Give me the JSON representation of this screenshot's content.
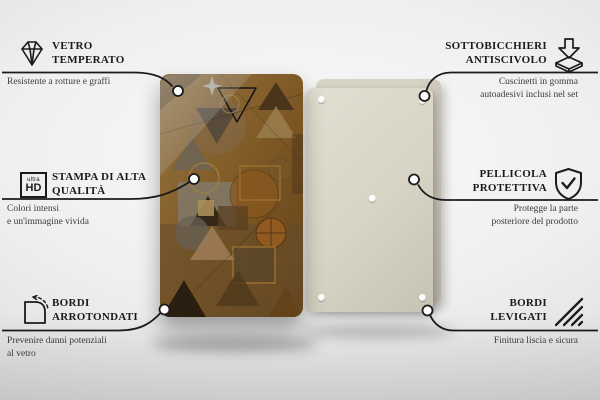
{
  "colors": {
    "text": "#1b1b1b",
    "subtext": "#3a3a3a",
    "line": "#1b1b1b",
    "back_panel": "#d7d4c5",
    "art_base_light": "#d2a259",
    "art_base_dark": "#8a5c24",
    "art_orange": "#c07a2b",
    "art_tan": "#d9b272",
    "art_dark_brown": "#3e2d18",
    "art_grey": "#908877",
    "art_gold_line": "#e0a84e"
  },
  "product": {
    "front_panel_label": "Pannello in vetro con stampa geometrica astratta (arancio e marrone)",
    "back_panel_label": "Retro del pannello con cuscinetti"
  },
  "callouts": {
    "left": [
      {
        "icon": "diamond-icon",
        "title_lines": [
          "VETRO",
          "TEMPERATO"
        ],
        "subtitle_lines": [
          "Resistente a rotture e graffi"
        ]
      },
      {
        "icon": "ultra-hd-icon",
        "icon_text_small": "ultra",
        "icon_text_big": "HD",
        "title_lines": [
          "STAMPA DI ALTA",
          "QUALITÀ"
        ],
        "subtitle_lines": [
          "Colori intensi",
          "e un'immagine vivida"
        ]
      },
      {
        "icon": "rounded-corner-icon",
        "title_lines": [
          "BORDI",
          "ARROTONDATI"
        ],
        "subtitle_lines": [
          "Prevenire danni potenziali",
          "al vetro"
        ]
      }
    ],
    "right": [
      {
        "icon": "press-down-icon",
        "title_lines": [
          "SOTTOBICCHIERI",
          "ANTISCIVOLO"
        ],
        "subtitle_lines": [
          "Cuscinetti in gomma",
          "autoadesivi inclusi nel set"
        ]
      },
      {
        "icon": "shield-check-icon",
        "title_lines": [
          "PELLICOLA",
          "PROTETTIVA"
        ],
        "subtitle_lines": [
          "Protegge la parte",
          "posteriore del prodotto"
        ]
      },
      {
        "icon": "hatch-lines-icon",
        "title_lines": [
          "BORDI",
          "LEVIGATI"
        ],
        "subtitle_lines": [
          "Finitura liscia e sicura"
        ]
      }
    ]
  }
}
